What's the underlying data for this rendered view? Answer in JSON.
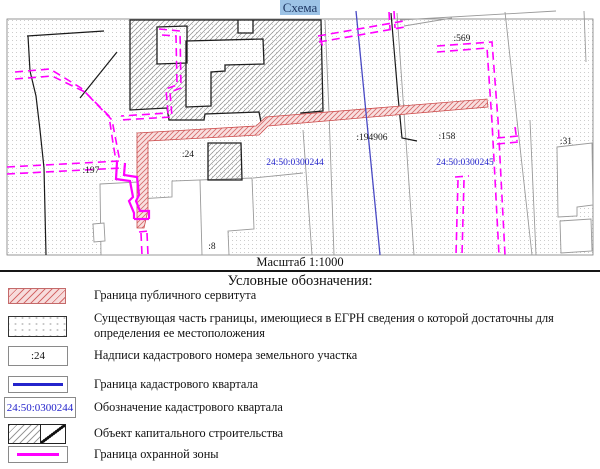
{
  "title": "Схема",
  "map": {
    "scale_label": "Масштаб 1:1000",
    "labels": {
      "l569": ":569",
      "l194906": ":194906",
      "l158": ":158",
      "l31": ":31",
      "l24": ":24",
      "l197": ":197",
      "l8": ":8",
      "q244": "24:50:0300244",
      "q245": "24:50:0300245"
    }
  },
  "legend": {
    "heading": "Условные обозначения:",
    "items": [
      {
        "label": "Граница публичного сервитута"
      },
      {
        "label": "Существующая часть границы, имеющиеся в ЕГРН сведения  о которой достаточны для определения  ее местоположения"
      },
      {
        "label": "Надписи кадастрового номера земельного участка",
        "symbol_text": ":24"
      },
      {
        "label": "Граница кадастрового квартала"
      },
      {
        "label": "Обозначение кадастрового квартала",
        "symbol_text": "24:50:0300244"
      },
      {
        "label": "Объект капитального строительства"
      },
      {
        "label": "Граница охранной зоны"
      }
    ]
  },
  "colors": {
    "title_highlight": "#9dc3e6",
    "title_text": "#1f3864",
    "protection_zone_magenta": "#ff00ff",
    "servitude_fill": "#f9e0e0",
    "servitude_hatch": "#d46a6a",
    "quarter_boundary_blue": "#2424cc",
    "quarter_label_blue": "#2424cc",
    "building_outline": "#1f1f1f",
    "parcel_gray": "#9a9a9a"
  }
}
